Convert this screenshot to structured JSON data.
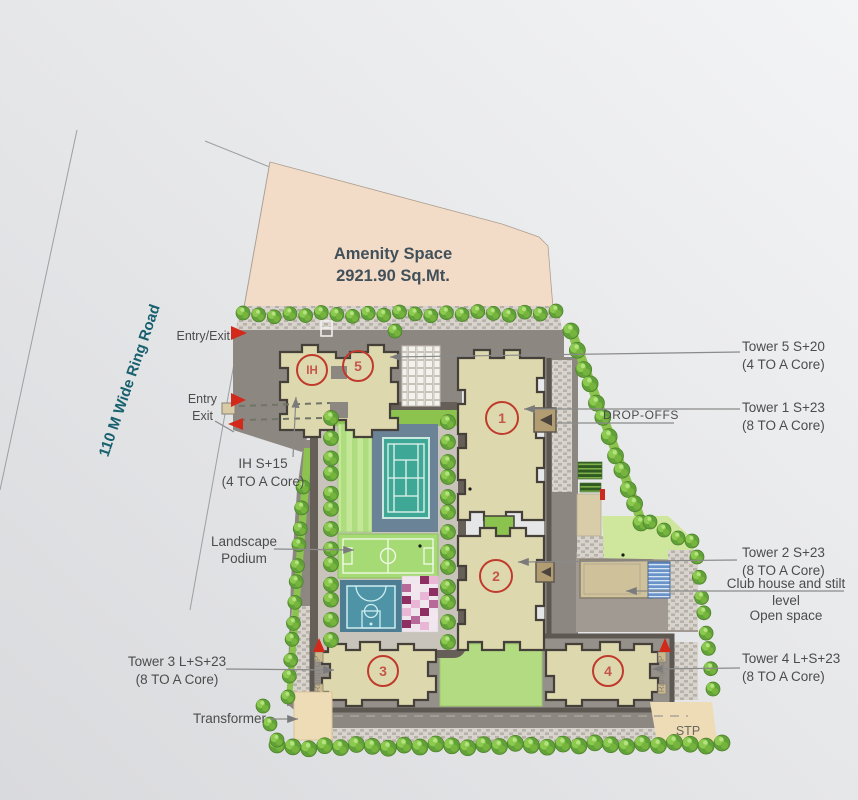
{
  "amenity": {
    "line1": "Amenity Space",
    "line2": "2921.90 Sq.Mt."
  },
  "ring_road": "110 M Wide Ring Road",
  "access": {
    "entry_exit": "Entry/Exit",
    "entry": "Entry",
    "exit": "Exit"
  },
  "towers": {
    "ih": {
      "badge": "IH",
      "line1": "IH S+15",
      "line2": "(4 TO A Core)"
    },
    "t5": {
      "badge": "5",
      "line1": "Tower 5 S+20",
      "line2": "(4 TO A Core)"
    },
    "t1": {
      "badge": "1",
      "line1": "Tower 1 S+23",
      "line2": "(8 TO A Core)"
    },
    "t2": {
      "badge": "2",
      "line1": "Tower 2 S+23",
      "line2": "(8 TO A Core)"
    },
    "t3": {
      "badge": "3",
      "line1": "Tower 3 L+S+23",
      "line2": "(8 TO A Core)"
    },
    "t4": {
      "badge": "4",
      "line1": "Tower 4 L+S+23",
      "line2": "(8 TO A Core)"
    }
  },
  "labels": {
    "drop_offs": "DROP-OFFS",
    "club_house_line1": "Club house and stilt",
    "club_house_line2": "level",
    "club_house_line3": "Open space",
    "landscape_line1": "Landscape",
    "landscape_line2": "Podium",
    "transformer": "Transformer",
    "stp": "STP",
    "ramp_up": "Ramp UP"
  },
  "colors": {
    "accent_red": "#d2291b",
    "badge_red": "#bf3a2c",
    "amenity_peach": "#f2dcc8",
    "road_gray": "#8d8781",
    "building_beige": "#ded8ae",
    "tree_green": "#61a139",
    "lawn_green": "#a6da74",
    "court_teal": "#3fa795",
    "court_blue": "#6b8396",
    "road_text_teal": "#17606e",
    "label_gray": "#4c4c4c"
  }
}
